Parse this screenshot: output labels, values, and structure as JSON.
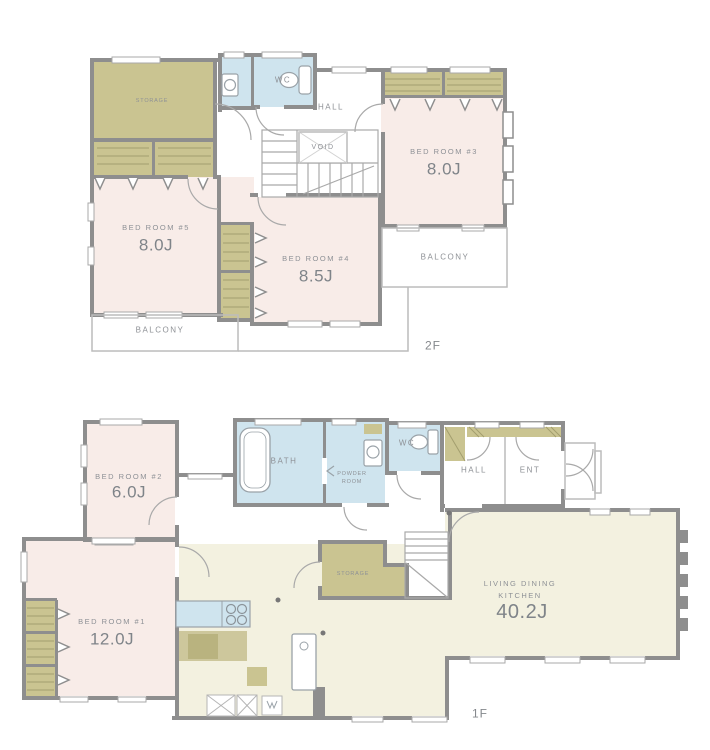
{
  "title": "2-story house floor plan",
  "colors": {
    "wall": "#8e8e8e",
    "room_pink": "#f8ece8",
    "closet_olive": "#cac491",
    "wet_blue": "#cfe4ee",
    "ldk_cream": "#f3f1e0",
    "line_thin": "#a9a9a9",
    "text": "#8e9196"
  },
  "floor2": {
    "label": "2F",
    "storage": "STORAGE",
    "wc": "WC",
    "hall": "HALL",
    "void": "VOID",
    "bedroom3": {
      "name": "BED ROOM #3",
      "size": "8.0J"
    },
    "bedroom4": {
      "name": "BED ROOM #4",
      "size": "8.5J"
    },
    "bedroom5": {
      "name": "BED ROOM #5",
      "size": "8.0J"
    },
    "balcony_right": "BALCONY",
    "balcony_bottom": "BALCONY"
  },
  "floor1": {
    "label": "1F",
    "bedroom2": {
      "name": "BED ROOM #2",
      "size": "6.0J"
    },
    "bedroom1": {
      "name": "BED ROOM #1",
      "size": "12.0J"
    },
    "bath": "BATH",
    "powder_room": {
      "line1": "POWDER",
      "line2": "ROOM"
    },
    "wc": "WC",
    "hall": "HALL",
    "ent": "ENT",
    "storage": "STORAGE",
    "ldk": {
      "line1": "LIVING DINING",
      "line2": "KITCHEN",
      "size": "40.2J"
    }
  }
}
